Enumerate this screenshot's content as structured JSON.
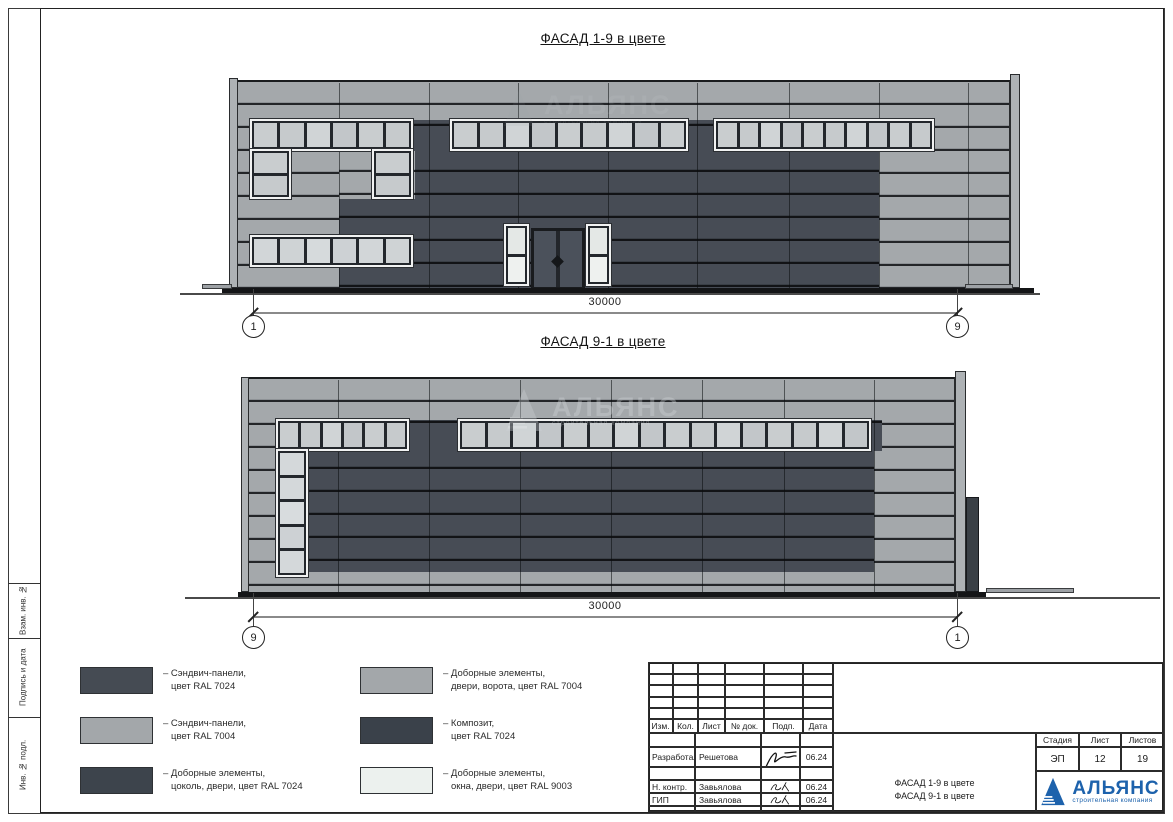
{
  "sheet_frame": {
    "labels": [
      "Взам. инв. №",
      "Подпись и дата",
      "Инв. № подл."
    ]
  },
  "facade_top": {
    "title": "ФАСАД 1-9 в цвете",
    "dimension_label": "30000",
    "axis_left": "1",
    "axis_right": "9"
  },
  "facade_bottom": {
    "title": "ФАСАД 9-1 в цвете",
    "dimension_label": "30000",
    "axis_left": "9",
    "axis_right": "1"
  },
  "watermark": {
    "name": "АЛЬЯНС",
    "tagline": "строительная компания"
  },
  "legend": {
    "items": [
      {
        "swatch_color": "#454b53",
        "line1": "– Сэндвич-панели,",
        "line2": "цвет RAL 7024"
      },
      {
        "swatch_color": "#a3a7aa",
        "line1": "– Сэндвич-панели,",
        "line2": "цвет RAL 7004"
      },
      {
        "swatch_color": "#3d444c",
        "line1": "– Доборные элементы,",
        "line2": "цоколь, двери, цвет RAL 7024"
      },
      {
        "swatch_color": "#a3a7aa",
        "line1": "– Доборные элементы,",
        "line2": "двери, ворота, цвет RAL 7004"
      },
      {
        "swatch_color": "#3a414a",
        "line1": "– Композит,",
        "line2": "цвет RAL 7024"
      },
      {
        "swatch_color": "#ecf1ee",
        "line1": "– Доборные элементы,",
        "line2": "окна, двери, цвет RAL 9003"
      }
    ]
  },
  "stamp": {
    "change_table_headers": [
      "Изм.",
      "Кол.",
      "Лист",
      "№ док.",
      "Подп.",
      "Дата"
    ],
    "signature_rows": [
      {
        "role": "Разработал",
        "name": "Решетова",
        "date": "06.24"
      },
      {
        "role": "Н. контр.",
        "name": "Завьялова",
        "date": "06.24"
      },
      {
        "role": "ГИП",
        "name": "Завьялова",
        "date": "06.24"
      }
    ],
    "doc_title_line1": "ФАСАД 1-9 в цвете",
    "doc_title_line2": "ФАСАД 9-1 в цвете",
    "stage_header": "Стадия",
    "sheet_header": "Лист",
    "sheets_header": "Листов",
    "stage_value": "ЭП",
    "sheet_value": "12",
    "sheets_value": "19",
    "logo_name": "АЛЬЯНС",
    "logo_tagline": "строительная компания"
  },
  "colors": {
    "ral_7024": "#454b53",
    "ral_7004": "#a3a7aa",
    "ral_9003": "#ecf1ee",
    "composite_7024": "#3a414a",
    "logo_blue": "#1d62ac"
  }
}
